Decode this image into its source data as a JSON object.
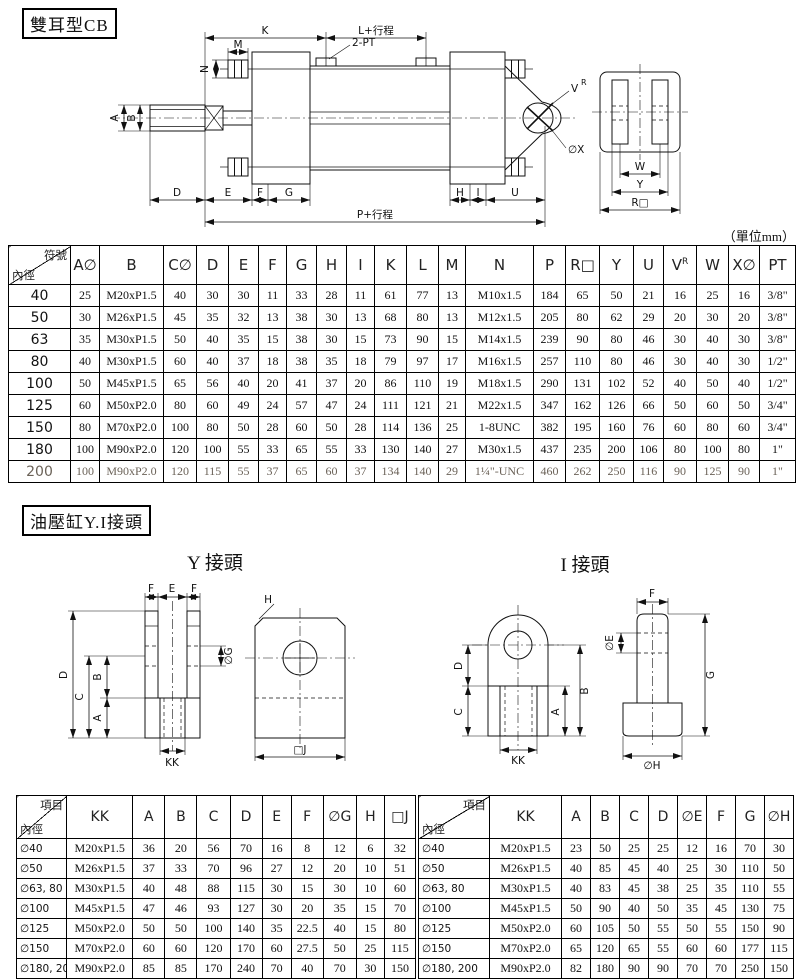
{
  "page": {
    "unit_note": "（單位mm）"
  },
  "section_cb": {
    "title": "雙耳型CB"
  },
  "section_yi": {
    "title": "油壓缸Y.I接頭",
    "y_title": "Y 接頭",
    "i_title": "I 接頭"
  },
  "drawing_cb": {
    "labels": {
      "k": "K",
      "m": "M",
      "n": "N",
      "l_plus_stroke": "L+行程",
      "two_pt": "2-PT",
      "v": "V",
      "v_sup": "R",
      "ox": "∅X",
      "a": "A",
      "b": "B",
      "d": "D",
      "e": "E",
      "f": "F",
      "g": "G",
      "h": "H",
      "i": "I",
      "u": "U",
      "p_plus_stroke": "P+行程",
      "w": "W",
      "y": "Y",
      "r_square": "R□"
    }
  },
  "drawing_y": {
    "labels": {
      "f_left": "F",
      "e": "E",
      "f_right": "F",
      "d": "D",
      "c": "C",
      "b": "B",
      "a": "A",
      "og": "∅G",
      "kk": "KK",
      "h": "H",
      "j_square": "□J"
    }
  },
  "drawing_i": {
    "labels": {
      "d": "D",
      "c": "C",
      "b": "B",
      "a": "A",
      "kk": "KK",
      "f": "F",
      "oe": "∅E",
      "g": "G",
      "oh": "∅H"
    }
  },
  "tables": {
    "main": {
      "corner_top": "符號",
      "corner_bottom": "內徑",
      "columns": [
        "A∅",
        "B",
        "C∅",
        "D",
        "E",
        "F",
        "G",
        "H",
        "I",
        "K",
        "L",
        "M",
        "N",
        "P",
        "R□",
        "Y",
        "U",
        "V^R",
        "W",
        "X∅",
        "PT"
      ],
      "rows": [
        {
          "label": "40",
          "values": [
            "25",
            "M20xP1.5",
            "40",
            "30",
            "30",
            "11",
            "33",
            "28",
            "11",
            "61",
            "77",
            "13",
            "M10x1.5",
            "184",
            "65",
            "50",
            "21",
            "16",
            "25",
            "16",
            "3/8\""
          ]
        },
        {
          "label": "50",
          "values": [
            "30",
            "M26xP1.5",
            "45",
            "35",
            "32",
            "13",
            "38",
            "30",
            "13",
            "68",
            "80",
            "13",
            "M12x1.5",
            "205",
            "80",
            "62",
            "29",
            "20",
            "30",
            "20",
            "3/8\""
          ]
        },
        {
          "label": "63",
          "values": [
            "35",
            "M30xP1.5",
            "50",
            "40",
            "35",
            "15",
            "38",
            "30",
            "15",
            "73",
            "90",
            "15",
            "M14x1.5",
            "239",
            "90",
            "80",
            "46",
            "30",
            "40",
            "30",
            "3/8\""
          ]
        },
        {
          "label": "80",
          "values": [
            "40",
            "M30xP1.5",
            "60",
            "40",
            "37",
            "18",
            "38",
            "35",
            "18",
            "79",
            "97",
            "17",
            "M16x1.5",
            "257",
            "110",
            "80",
            "46",
            "30",
            "40",
            "30",
            "1/2\""
          ]
        },
        {
          "label": "100",
          "values": [
            "50",
            "M45xP1.5",
            "65",
            "56",
            "40",
            "20",
            "41",
            "37",
            "20",
            "86",
            "110",
            "19",
            "M18x1.5",
            "290",
            "131",
            "102",
            "52",
            "40",
            "50",
            "40",
            "1/2\""
          ]
        },
        {
          "label": "125",
          "values": [
            "60",
            "M50xP2.0",
            "80",
            "60",
            "49",
            "24",
            "57",
            "47",
            "24",
            "111",
            "121",
            "21",
            "M22x1.5",
            "347",
            "162",
            "126",
            "66",
            "50",
            "60",
            "50",
            "3/4\""
          ]
        },
        {
          "label": "150",
          "values": [
            "80",
            "M70xP2.0",
            "100",
            "80",
            "50",
            "28",
            "60",
            "50",
            "28",
            "114",
            "136",
            "25",
            "1-8UNC",
            "382",
            "195",
            "160",
            "76",
            "60",
            "80",
            "60",
            "3/4\""
          ]
        },
        {
          "label": "180",
          "values": [
            "100",
            "M90xP2.0",
            "120",
            "100",
            "55",
            "33",
            "65",
            "55",
            "33",
            "130",
            "140",
            "27",
            "M30x1.5",
            "437",
            "235",
            "200",
            "106",
            "80",
            "100",
            "80",
            "1\""
          ]
        },
        {
          "label": "200",
          "values": [
            "100",
            "M90xP2.0",
            "120",
            "115",
            "55",
            "37",
            "65",
            "60",
            "37",
            "134",
            "140",
            "29",
            "1¼\"-UNC",
            "460",
            "262",
            "250",
            "116",
            "90",
            "125",
            "90",
            "1\""
          ]
        }
      ]
    },
    "y_joint": {
      "corner_top": "項目",
      "corner_bottom": "內徑",
      "columns": [
        "KK",
        "A",
        "B",
        "C",
        "D",
        "E",
        "F",
        "∅G",
        "H",
        "□J"
      ],
      "rows": [
        {
          "label": "∅40",
          "values": [
            "M20xP1.5",
            "36",
            "20",
            "56",
            "70",
            "16",
            "8",
            "12",
            "6",
            "32"
          ]
        },
        {
          "label": "∅50",
          "values": [
            "M26xP1.5",
            "37",
            "33",
            "70",
            "96",
            "27",
            "12",
            "20",
            "10",
            "51"
          ]
        },
        {
          "label": "∅63, 80",
          "values": [
            "M30xP1.5",
            "40",
            "48",
            "88",
            "115",
            "30",
            "15",
            "30",
            "10",
            "60"
          ]
        },
        {
          "label": "∅100",
          "values": [
            "M45xP1.5",
            "47",
            "46",
            "93",
            "127",
            "30",
            "20",
            "35",
            "15",
            "70"
          ]
        },
        {
          "label": "∅125",
          "values": [
            "M50xP2.0",
            "50",
            "50",
            "100",
            "140",
            "35",
            "22.5",
            "40",
            "15",
            "80"
          ]
        },
        {
          "label": "∅150",
          "values": [
            "M70xP2.0",
            "60",
            "60",
            "120",
            "170",
            "60",
            "27.5",
            "50",
            "25",
            "115"
          ]
        },
        {
          "label": "∅180, 200",
          "values": [
            "M90xP2.0",
            "85",
            "85",
            "170",
            "240",
            "70",
            "40",
            "70",
            "30",
            "150"
          ]
        }
      ]
    },
    "i_joint": {
      "corner_top": "項目",
      "corner_bottom": "內徑",
      "columns": [
        "KK",
        "A",
        "B",
        "C",
        "D",
        "∅E",
        "F",
        "G",
        "∅H"
      ],
      "rows": [
        {
          "label": "∅40",
          "values": [
            "M20xP1.5",
            "23",
            "50",
            "25",
            "25",
            "12",
            "16",
            "70",
            "30"
          ]
        },
        {
          "label": "∅50",
          "values": [
            "M26xP1.5",
            "40",
            "85",
            "45",
            "40",
            "25",
            "30",
            "110",
            "50"
          ]
        },
        {
          "label": "∅63, 80",
          "values": [
            "M30xP1.5",
            "40",
            "83",
            "45",
            "38",
            "25",
            "35",
            "110",
            "55"
          ]
        },
        {
          "label": "∅100",
          "values": [
            "M45xP1.5",
            "50",
            "90",
            "40",
            "50",
            "35",
            "45",
            "130",
            "75"
          ]
        },
        {
          "label": "∅125",
          "values": [
            "M50xP2.0",
            "60",
            "105",
            "50",
            "55",
            "50",
            "55",
            "150",
            "90"
          ]
        },
        {
          "label": "∅150",
          "values": [
            "M70xP2.0",
            "65",
            "120",
            "65",
            "55",
            "60",
            "60",
            "177",
            "115"
          ]
        },
        {
          "label": "∅180, 200",
          "values": [
            "M90xP2.0",
            "82",
            "180",
            "90",
            "90",
            "70",
            "70",
            "250",
            "150"
          ]
        }
      ]
    }
  }
}
